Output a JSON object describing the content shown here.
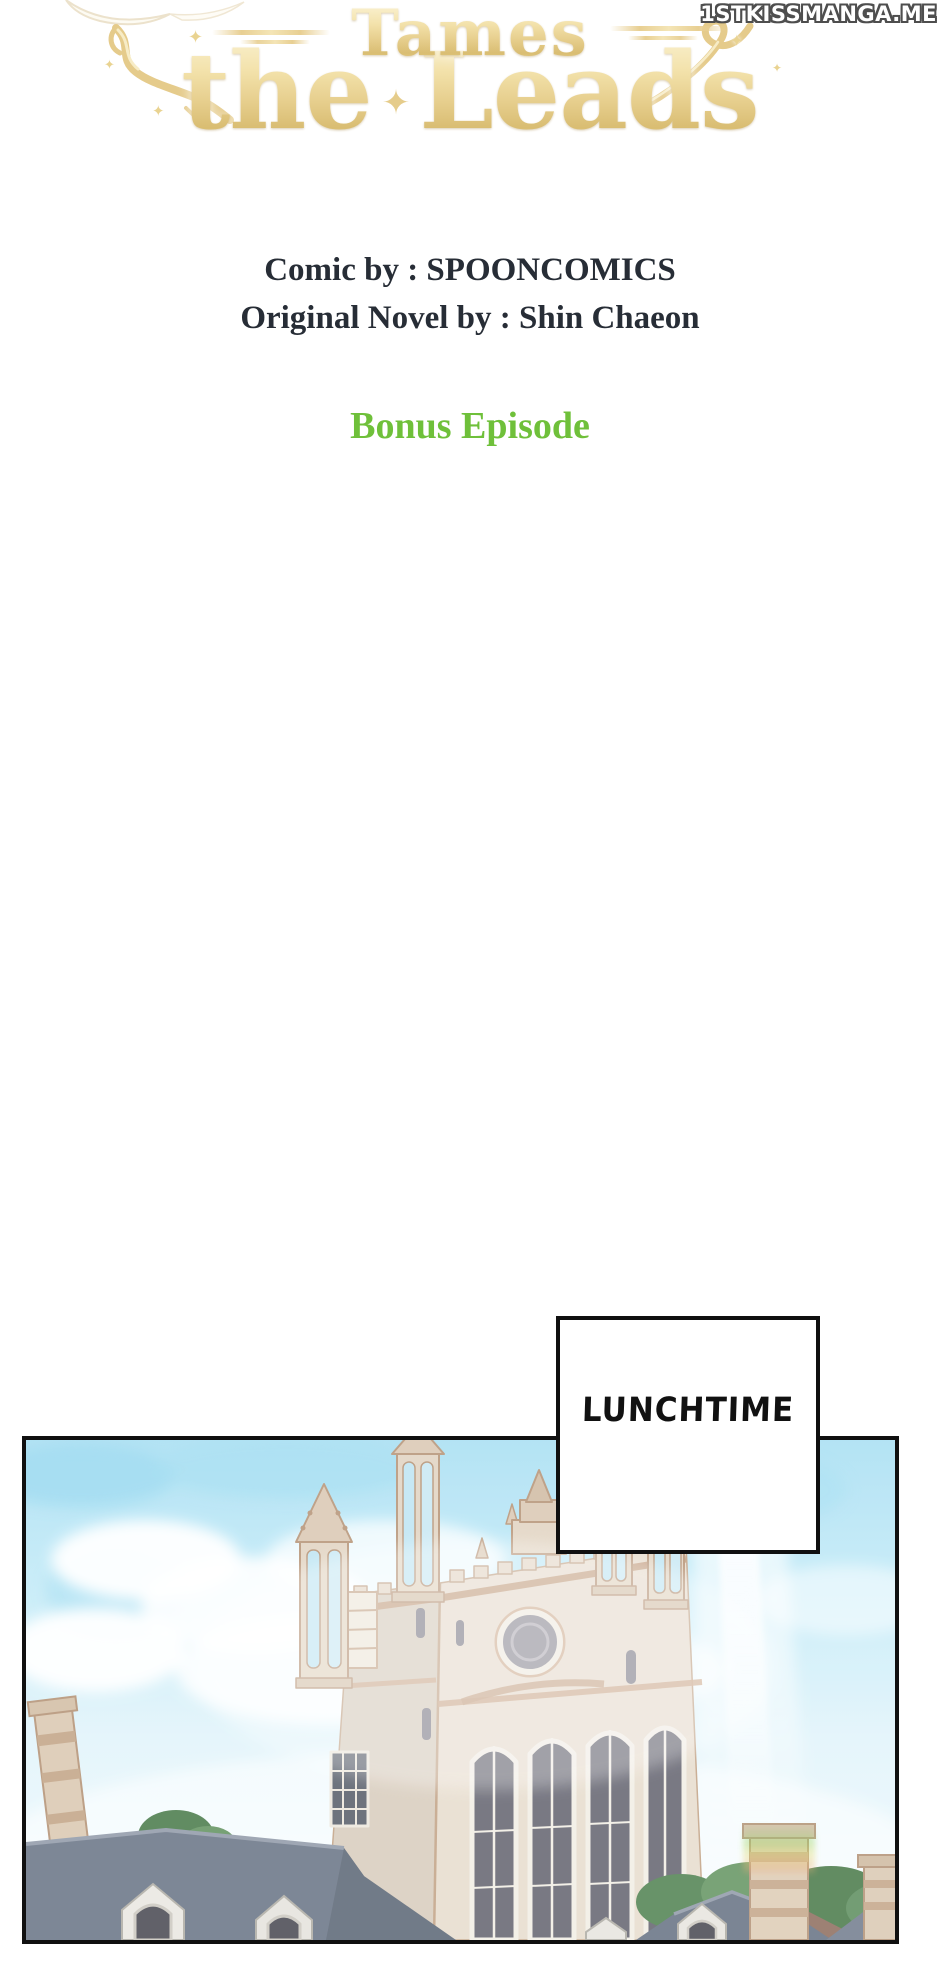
{
  "watermark": {
    "text": "1STKISSMANGA.ME"
  },
  "title": {
    "line1": "Tames",
    "line2_left": "the",
    "line2_right": "Leads",
    "gold_color": "#e5cc8b"
  },
  "decor": {
    "sparkle_char": "✦"
  },
  "credits": {
    "comic_by": "Comic by : SPOONCOMICS",
    "novel_by": "Original Novel by : Shin Chaeon",
    "text_color": "#272d36"
  },
  "episode": {
    "label": "Bonus Episode",
    "color": "#6fc03a"
  },
  "speech": {
    "text": "LUNCHTIME"
  },
  "panel": {
    "alt": "Pale gothic cathedral with openwork spires under a hazy blue sky, sunbeam on the right, slate rooftops with dormers, chimneys and trees in the foreground",
    "colors": {
      "sky": "#b5e5f5",
      "wall": "#e9dfd1",
      "trim": "#c6a98f",
      "roof": "#747e8e",
      "tree": "#5d8b5e",
      "beam": "#ffffff"
    }
  }
}
